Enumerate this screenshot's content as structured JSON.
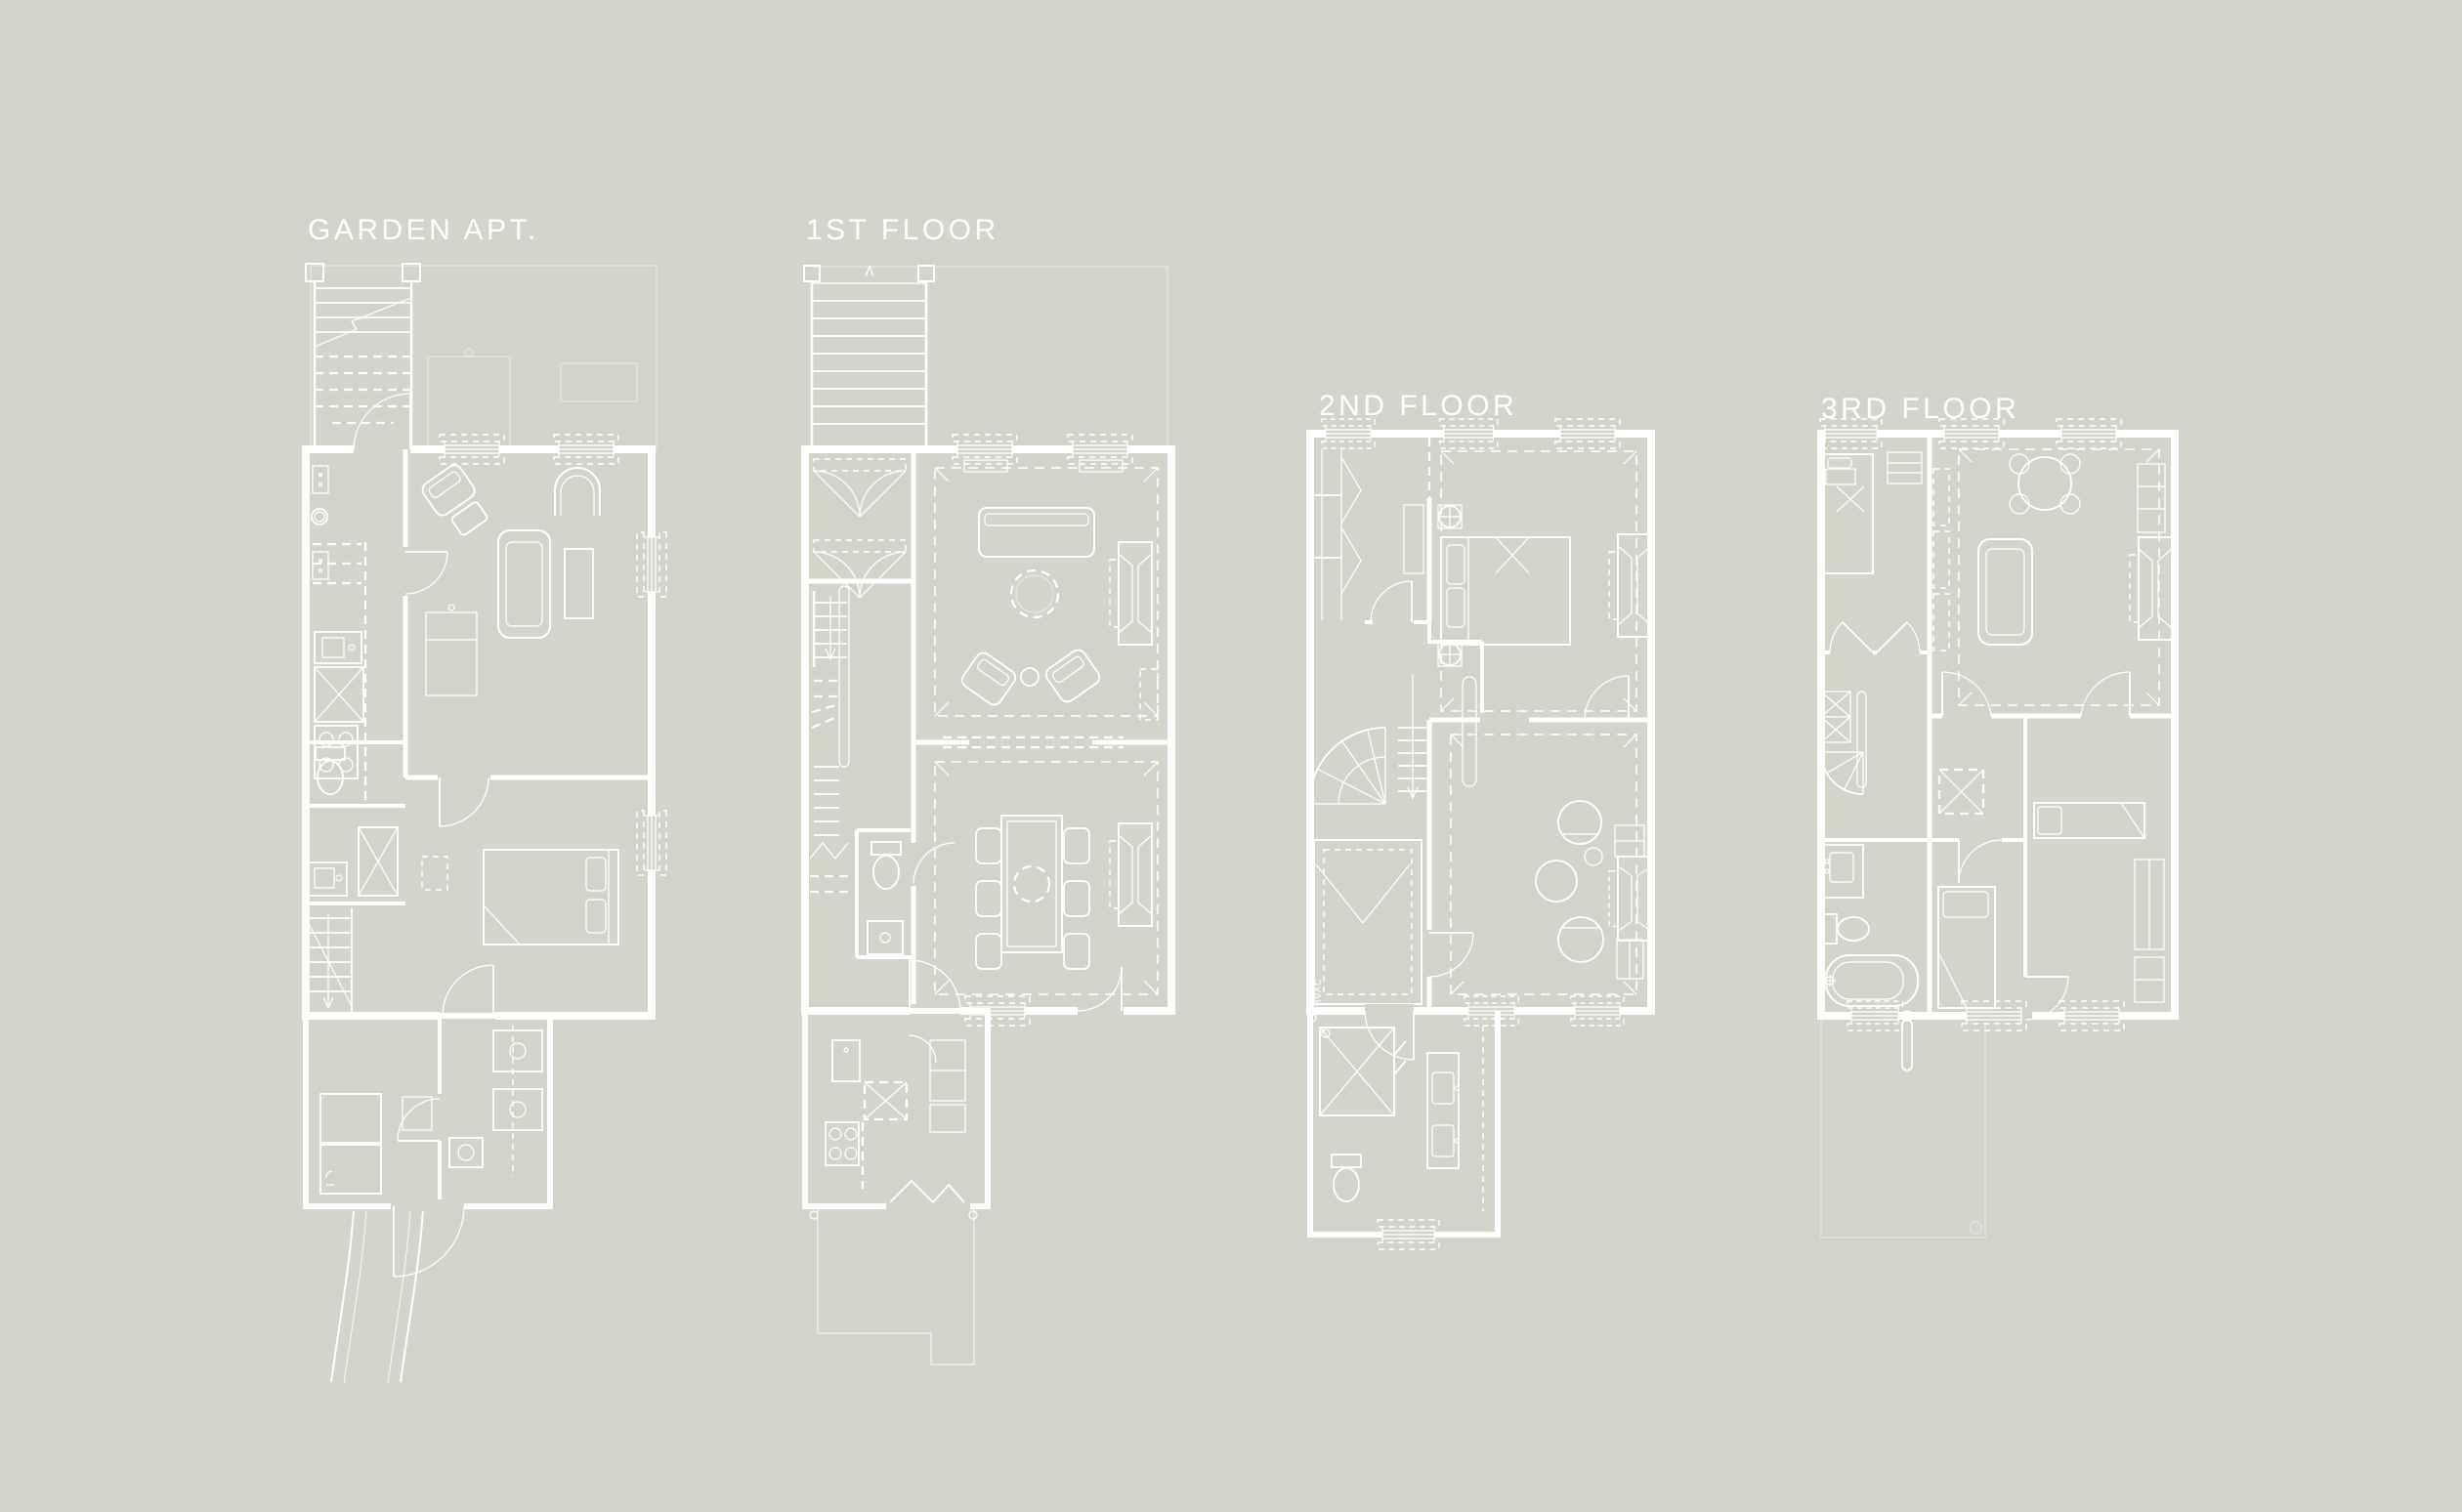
{
  "sheet": {
    "type": "architectural-floor-plans",
    "background_color": "#d5d4cc",
    "line_color": "#ffffff"
  },
  "plans": [
    {
      "id": "garden-apt",
      "label": "GARDEN APT.",
      "features": [
        "entry-stair",
        "under-stoop-storage",
        "electrical-panels",
        "kitchen",
        "sink",
        "refrigerator",
        "range",
        "toilet",
        "vanity",
        "linen-closet",
        "laundry-stair",
        "living-room",
        "armchair",
        "fireplace",
        "sofa",
        "bedroom",
        "double-bed",
        "utility-room",
        "storage-shelves",
        "garden-path"
      ]
    },
    {
      "id": "first-floor",
      "label": "1ST FLOOR",
      "features": [
        "stoop-stair",
        "front-yard",
        "entry-vestibule",
        "coat-closets",
        "living-room",
        "sofa",
        "armchairs",
        "round-table",
        "fireplace",
        "cased-opening",
        "dining-room",
        "dining-table",
        "dining-chairs",
        "stair",
        "powder-room",
        "toilet",
        "shower",
        "kitchen",
        "refrigerator",
        "pantry",
        "range",
        "deck"
      ]
    },
    {
      "id": "second-floor",
      "label": "2ND FLOOR",
      "annotation": "HVAC",
      "features": [
        "stair-hall",
        "winder-stair",
        "master-bedroom",
        "double-bed",
        "ceiling-fixtures",
        "fireplace",
        "nursery",
        "crib",
        "sitting-room",
        "barrel-chairs",
        "round-table",
        "bookcases",
        "bathroom",
        "walk-in-shower",
        "toilet",
        "double-vanity"
      ]
    },
    {
      "id": "third-floor",
      "label": "3RD FLOOR",
      "features": [
        "bedroom",
        "single-bed",
        "nightstand",
        "closets",
        "living-room",
        "sofa",
        "round-table",
        "shelving",
        "fireplace",
        "winder-stair",
        "hall-closet",
        "bathroom",
        "vanity",
        "toilet",
        "bathtub",
        "second-bedroom",
        "third-bedroom",
        "wardrobes",
        "roof-below"
      ]
    }
  ]
}
